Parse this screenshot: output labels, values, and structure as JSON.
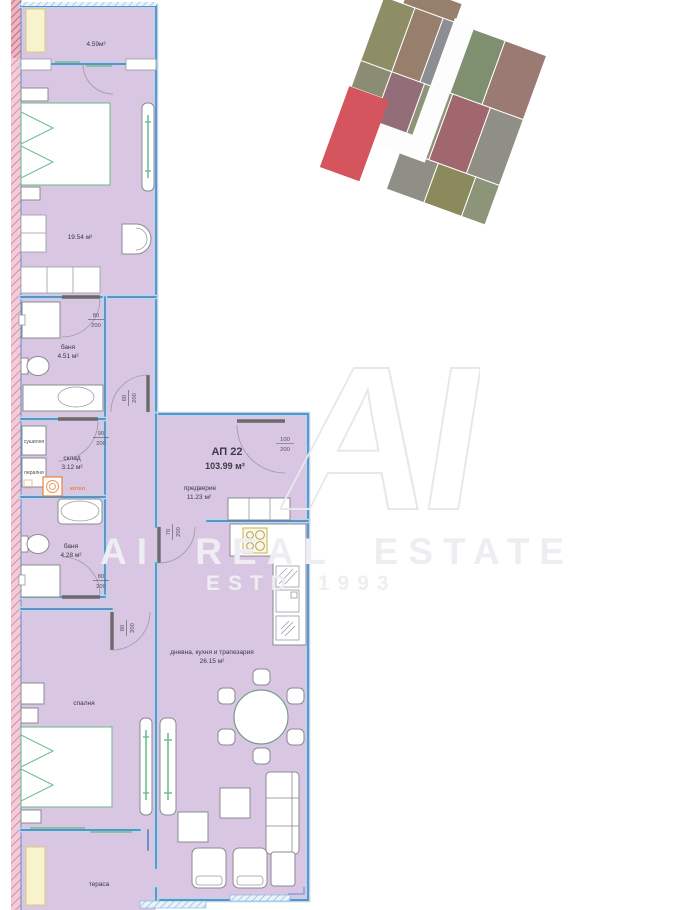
{
  "apartment": {
    "id": "АП 22",
    "total_area": "103.99 м²"
  },
  "watermark": {
    "logo": "AI",
    "line1": "AI REAL ESTATE",
    "line2": "ESTD 1993"
  },
  "rooms": [
    {
      "id": "balcony",
      "name": "",
      "area": "4.59м²"
    },
    {
      "id": "bedroom1",
      "name": "",
      "area": "19.54 м²"
    },
    {
      "id": "bath1",
      "name": "баня",
      "area": "4.51 м²"
    },
    {
      "id": "storage",
      "name": "склад",
      "area": "3.12 м²"
    },
    {
      "id": "entry",
      "name": "предверие",
      "area": "11.23 м²"
    },
    {
      "id": "bath2",
      "name": "баня",
      "area": "4.28 м²"
    },
    {
      "id": "living",
      "name": "дневна, кухня и трапезария",
      "area": "26.15 м²"
    },
    {
      "id": "bedroom2",
      "name": "спалня",
      "area": ""
    },
    {
      "id": "terrace",
      "name": "тераса",
      "area": ""
    }
  ],
  "appliances": {
    "dryer": "сушилня",
    "washer": "пералня",
    "boiler": "котел"
  },
  "doors": [
    {
      "id": "bath1-door",
      "w": "80",
      "h": "200"
    },
    {
      "id": "hall-door",
      "w": "60",
      "h": "200"
    },
    {
      "id": "storage-door",
      "w": "90",
      "h": "200"
    },
    {
      "id": "entry-door",
      "w": "100",
      "h": "200"
    },
    {
      "id": "kitchen-door",
      "w": "70",
      "h": "200"
    },
    {
      "id": "bath2-door",
      "w": "80",
      "h": "200"
    },
    {
      "id": "bedroom2-door",
      "w": "80",
      "h": "200"
    }
  ],
  "site_plan": {
    "highlight_color": "#d5555e"
  },
  "colors": {
    "floor_fill": "#d8c6e2",
    "wall_blue": "#3f7cb8",
    "wall_blue_light": "#b7d6ee",
    "exterior_wall_pink": "#f2cdd9",
    "exterior_wall_pink_dark": "#d47b95",
    "furniture_green": "#72bd90",
    "accent_orange": "#e8833a",
    "planter_yellow": "#f7f3cf",
    "watermark_gray": "#eeedf2"
  }
}
